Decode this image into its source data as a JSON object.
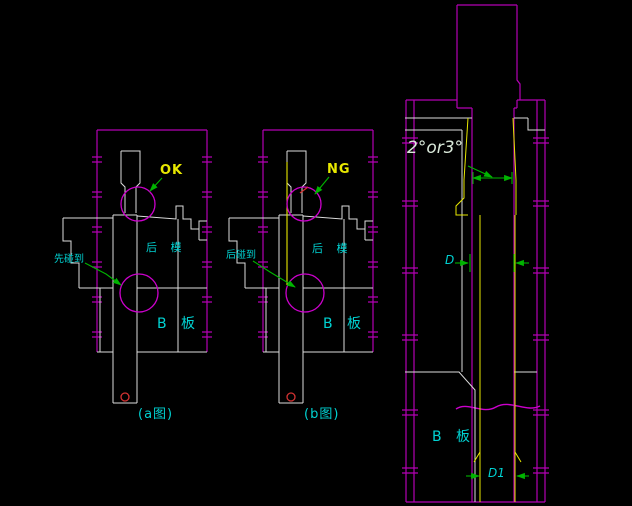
{
  "drawing": {
    "title": "mold air-poppet pin OK/NG comparison drawing",
    "colors": {
      "background": "#000000",
      "border_magenta": "#b400b4",
      "highlight_magenta": "#cc00cc",
      "outline_white": "#dcdcdc",
      "pin_yellow": "#e8e800",
      "text_cyan": "#00d2d2",
      "leader_green": "#00b400",
      "angle_text_green": "#d9e8d9",
      "mark_red": "#d23232"
    },
    "figures": {
      "a": {
        "result": "OK",
        "mold_label": "后 模",
        "plate_label": "B 板",
        "leader_label": "先碰到",
        "caption": "(a图)"
      },
      "b": {
        "result": "NG",
        "mold_label": "后 模",
        "plate_label": "B 板",
        "leader_label": "后碰到",
        "caption": "(b图)"
      },
      "detail": {
        "angle_label": "2°or3°",
        "dim_d_label": "D",
        "dim_d1_label": "D1",
        "plate_label": "B 板"
      }
    }
  }
}
